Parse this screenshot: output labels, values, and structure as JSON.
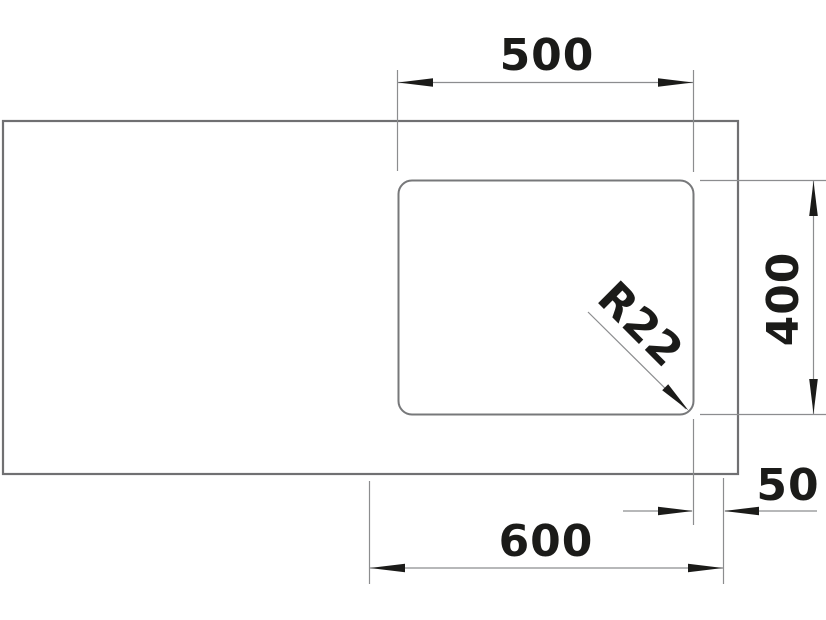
{
  "drawing": {
    "type": "technical-installation-drawing",
    "colors": {
      "background": "#ffffff",
      "outline": "#707072",
      "dimension_line": "#8c8d8f",
      "ink": "#1b1b19"
    },
    "shapes": {
      "countertop": "rectangle",
      "cutout": "rounded-rectangle"
    },
    "dimensions": {
      "top_width": {
        "label": "500"
      },
      "right_height": {
        "label": "400"
      },
      "corner_radius": {
        "label": "R22"
      },
      "bottom_width": {
        "label": "600"
      },
      "edge_offset": {
        "label": "50"
      }
    }
  }
}
